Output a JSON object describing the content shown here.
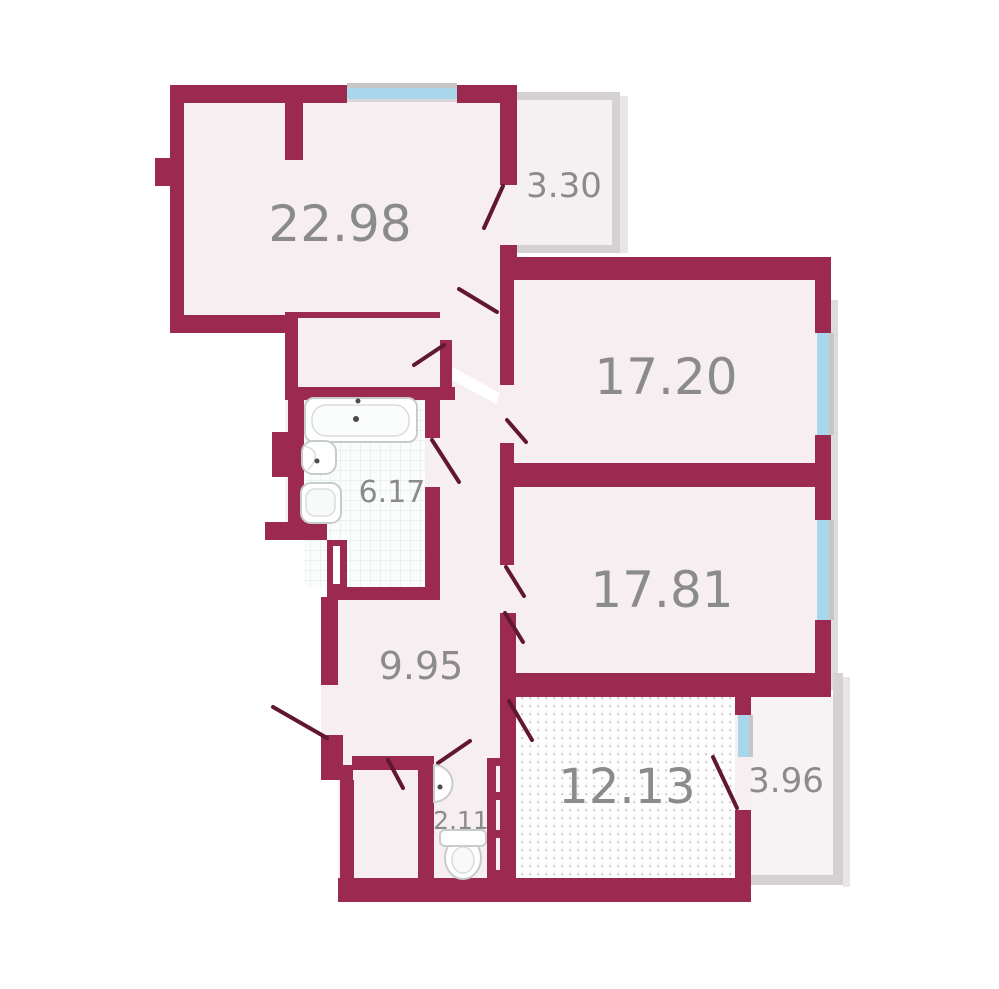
{
  "plan": {
    "name": "apartment-floor-plan",
    "rooms": [
      {
        "id": "living-room",
        "area": "22.98"
      },
      {
        "id": "balcony-top",
        "area": "3.30"
      },
      {
        "id": "bedroom-1",
        "area": "17.20"
      },
      {
        "id": "bedroom-2",
        "area": "17.81"
      },
      {
        "id": "bathroom",
        "area": "6.17"
      },
      {
        "id": "hallway",
        "area": "9.95"
      },
      {
        "id": "wc",
        "area": "2.11"
      },
      {
        "id": "kitchen",
        "area": "12.13"
      },
      {
        "id": "balcony-bottom",
        "area": "3.96"
      }
    ],
    "fixtures": [
      {
        "icon": "bathtub-icon",
        "room": "bathroom"
      },
      {
        "icon": "sink-icon",
        "room": "bathroom"
      },
      {
        "icon": "toilet-icon",
        "room": "bathroom"
      },
      {
        "icon": "corner-sink-icon",
        "room": "wc"
      },
      {
        "icon": "toilet-icon",
        "room": "wc"
      }
    ],
    "palette": {
      "wall": "#9C2950",
      "door_line": "#61172F",
      "room_fill": "#F7EEF2",
      "balcony_wall": "#D5D1D3",
      "balcony_fill": "#F5F1F3",
      "window_glass": "#A8D7EC",
      "window_frame": "#C8C5C6",
      "label_color": "#8C8B8B",
      "tile_line": "#DCE8DF",
      "kitchen_dot": "#C8C6C7",
      "outside": "#FFFFFF"
    }
  }
}
